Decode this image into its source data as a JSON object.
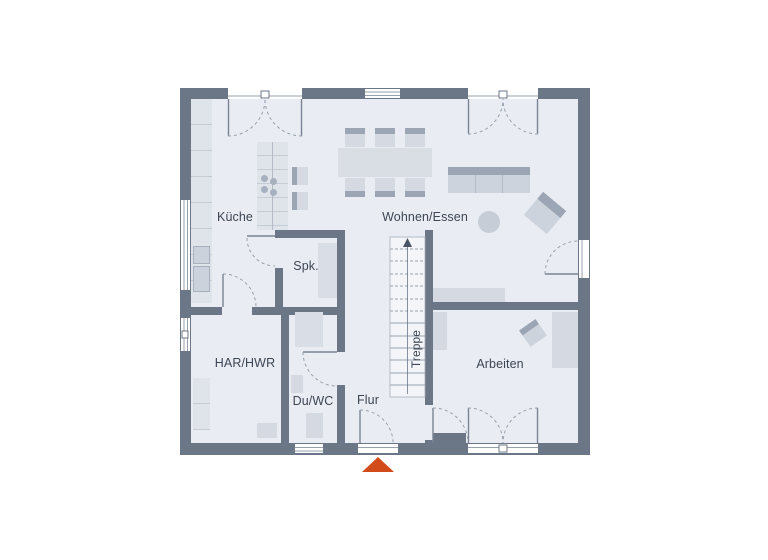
{
  "plan": {
    "type": "floor-plan",
    "rooms": {
      "kueche": {
        "label": "Küche"
      },
      "wohnen_essen": {
        "label": "Wohnen/Essen"
      },
      "spk": {
        "label": "Spk."
      },
      "har_hwr": {
        "label": "HAR/HWR"
      },
      "du_wc": {
        "label": "Du/WC"
      },
      "flur": {
        "label": "Flur"
      },
      "arbeiten": {
        "label": "Arbeiten"
      }
    },
    "stairs": {
      "label": "Treppe",
      "direction_arrow": "up"
    },
    "markers": {
      "entrance_arrow": "entrance"
    },
    "colors": {
      "wall": "#6b7787",
      "floor": "#e9ecf2",
      "furn": "#d5dae2",
      "furn_light": "#dfe3ea",
      "furn_dark": "#9ba5b4",
      "line": "#c6ccd6",
      "marker": "#d24b1b",
      "text": "#3d4654"
    }
  }
}
